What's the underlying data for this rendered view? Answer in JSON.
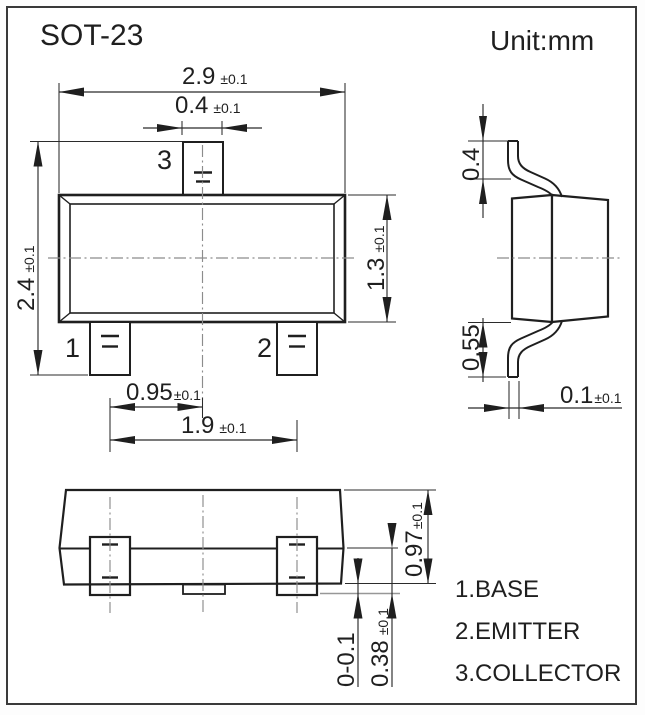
{
  "header": {
    "title": "SOT-23",
    "unit": "Unit:mm"
  },
  "top_view": {
    "pin_labels": {
      "pin1": "1",
      "pin2": "2",
      "pin3": "3"
    },
    "dims": {
      "overall_width": {
        "value": "2.9",
        "tol": "±0.1"
      },
      "pin3_width": {
        "value": "0.4",
        "tol": "±0.1"
      },
      "overall_height": {
        "value": "2.4",
        "tol": "±0.1"
      },
      "body_depth": {
        "value": "1.3",
        "tol": "±0.1"
      },
      "pin_pitch": {
        "value": "0.95",
        "tol": "±0.1"
      },
      "pin_span": {
        "value": "1.9",
        "tol": "±0.1"
      }
    }
  },
  "side_view": {
    "dims": {
      "lead_top_height": {
        "value": "0.4"
      },
      "lead_bottom_height": {
        "value": "0.55"
      },
      "lead_thickness": {
        "value": "0.1",
        "tol": "±0.1"
      }
    }
  },
  "front_view": {
    "dims": {
      "body_height": {
        "value": "0.97",
        "tol": "±0.1"
      },
      "standoff": {
        "value": "0-0.1"
      },
      "lead_foot_height": {
        "value": "0.38",
        "tol": "±0.1"
      }
    }
  },
  "legend": {
    "items": [
      "1.BASE",
      "2.EMITTER",
      "3.COLLECTOR"
    ]
  }
}
